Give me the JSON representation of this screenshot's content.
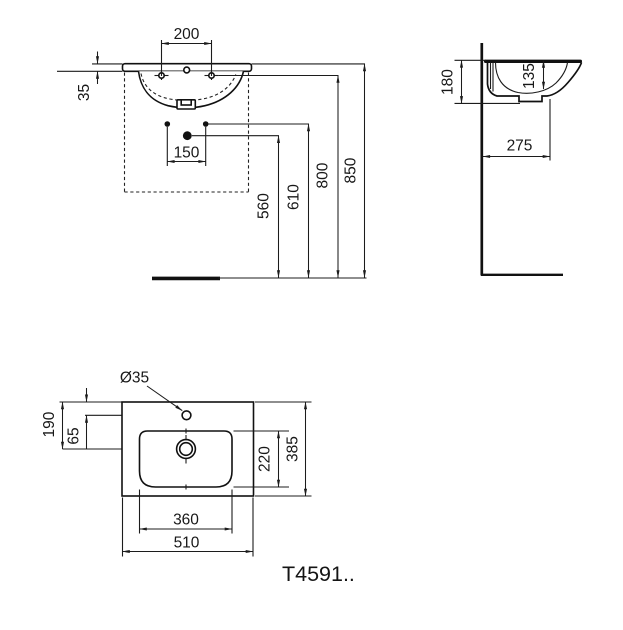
{
  "drawing": {
    "product_code": "T4591..",
    "front_view": {
      "dims": {
        "tap_hole_spacing": "200",
        "rim_thickness": "35",
        "fixing_hole_spacing": "150",
        "waste_height": "560",
        "fixing_height": "610",
        "tap_level_height": "800",
        "rim_height": "850"
      }
    },
    "side_view": {
      "dims": {
        "front_height": "180",
        "bowl_inner_depth": "135",
        "depth_from_wall": "275"
      }
    },
    "plan_view": {
      "dims": {
        "tap_hole_diameter": "Ø35",
        "drain_offset_from_back": "190",
        "tap_hole_offset": "65",
        "bowl_depth": "220",
        "overall_depth": "385",
        "bowl_width": "360",
        "overall_width": "510"
      }
    }
  }
}
